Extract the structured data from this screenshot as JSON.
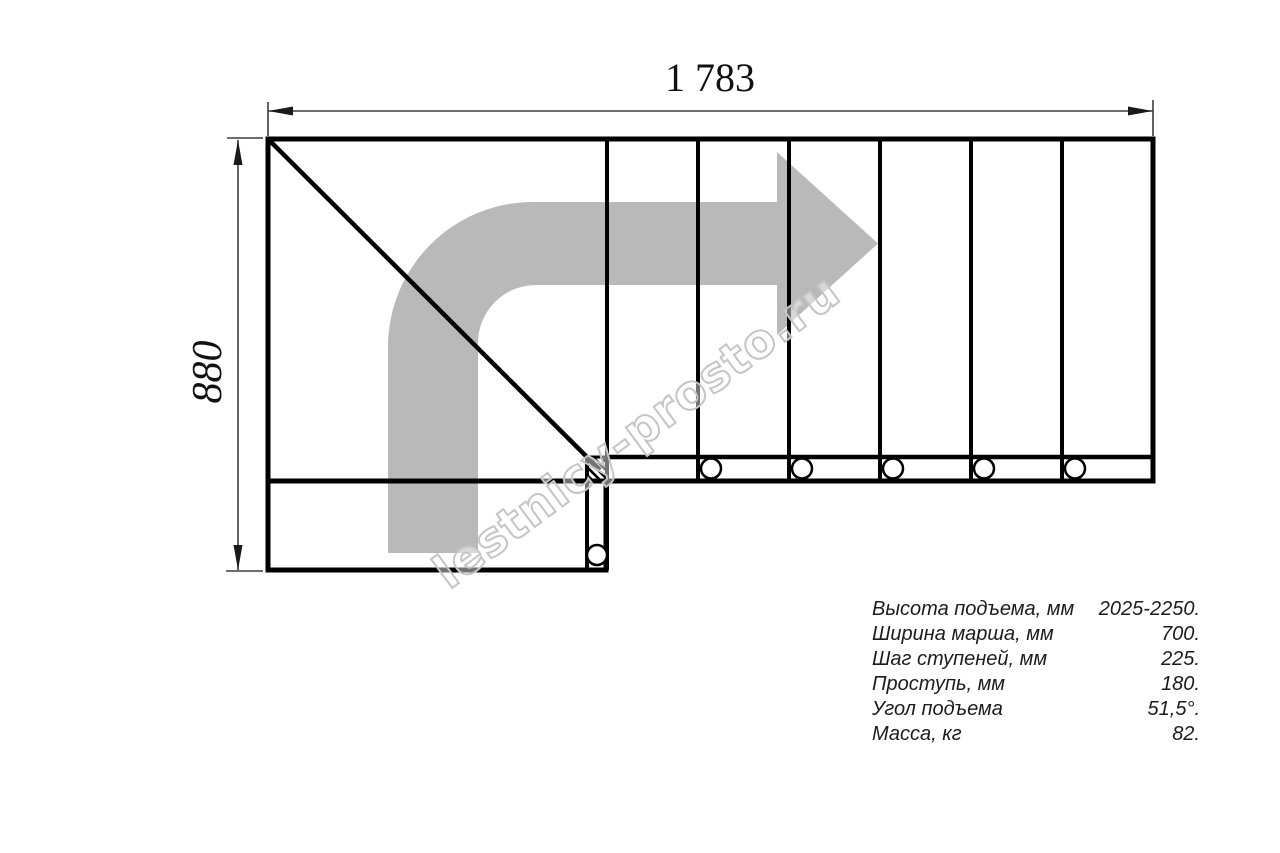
{
  "drawing": {
    "top_dimension": "1 783",
    "left_dimension": "880",
    "watermark": "lestnicy-prosto.ru",
    "colors": {
      "line": "#000000",
      "dimension": "#3d3d3d",
      "arrow_fill": "#b9b9b9",
      "watermark_outline": "#c5c5c5",
      "background": "#ffffff"
    }
  },
  "specs": {
    "rows": [
      {
        "label": "Высота подъема, мм",
        "value": "2025-2250."
      },
      {
        "label": "Ширина марша, мм",
        "value": "700."
      },
      {
        "label": "Шаг ступеней, мм",
        "value": "225."
      },
      {
        "label": "Проступь, мм",
        "value": "180."
      },
      {
        "label": "Угол подъема",
        "value": "51,5°."
      },
      {
        "label": "Масса, кг",
        "value": "82."
      }
    ]
  }
}
